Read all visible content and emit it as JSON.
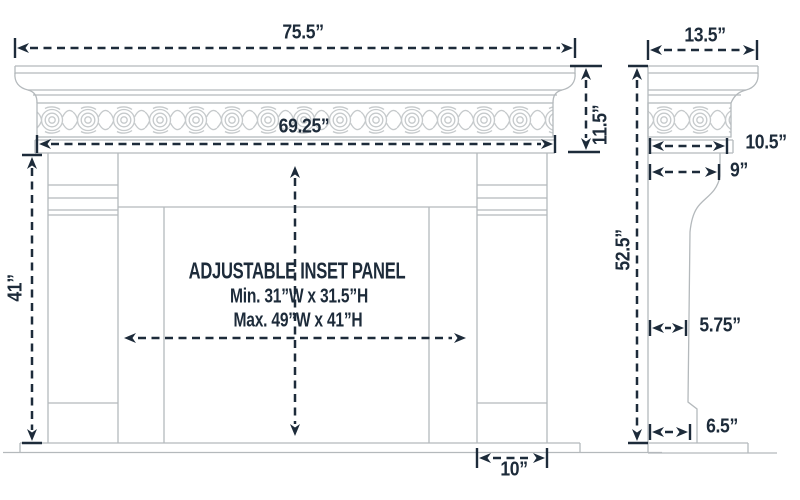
{
  "diagram": {
    "type": "fireplace-mantel-dimension-drawing",
    "front_view": {
      "labels": {
        "overall_width": "75.5”",
        "frieze_width": "69.25”",
        "header_height": "11.5”",
        "leg_height": "41”",
        "leg_width": "10”"
      },
      "inset_panel": {
        "title": "ADJUSTABLE INSET PANEL",
        "min": "Min. 31”W x 31.5”H",
        "max": "Max. 49”W x 41”H"
      }
    },
    "side_view": {
      "labels": {
        "shelf_depth": "13.5”",
        "shelf_bottom_depth": "10.5”",
        "header_depth": "9”",
        "overall_height": "52.5”",
        "leg_depth": "5.75”",
        "base_depth": "6.5”"
      }
    },
    "colors": {
      "dimension": "#1d2b3a",
      "linework": "#b4b9bc",
      "ornament": "#c6cacc",
      "background": "#ffffff"
    }
  }
}
